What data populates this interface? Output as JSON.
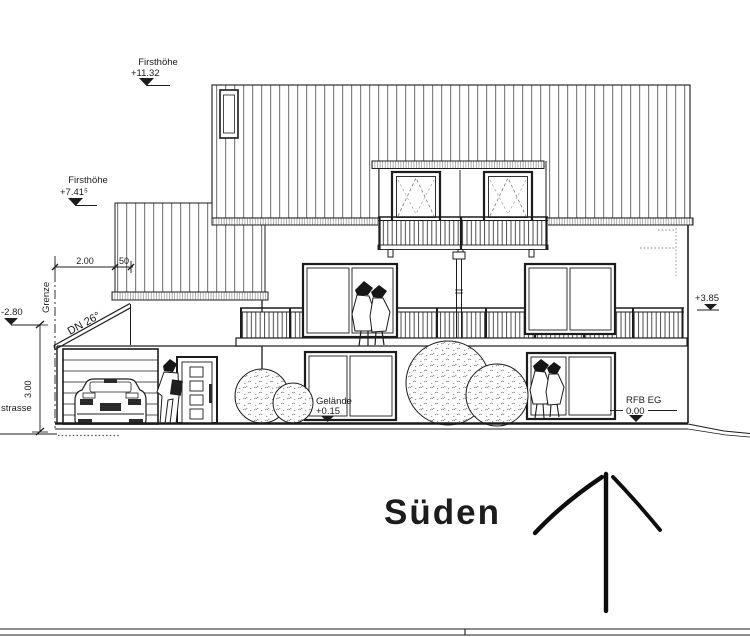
{
  "sheet": {
    "title": "Süden"
  },
  "levels": {
    "ridge_main": {
      "label": "Firsthöhe",
      "value": "+11.32"
    },
    "ridge_garage": {
      "label": "Firsthöhe",
      "value": "+7.41⁵"
    },
    "street_level": {
      "value": "-2.80"
    },
    "street_name": {
      "value": "strasse"
    },
    "terrain": {
      "label": "Gelände",
      "value": "+0.15"
    },
    "floor": {
      "label": "RFB EG",
      "value": "0.00"
    },
    "balcony": {
      "value": "+3.85"
    }
  },
  "dimensions": {
    "boundary_offset": "2.00",
    "eaves_overhang": "50",
    "garage_height": "3.00"
  },
  "labels": {
    "boundary": "Grenze",
    "roof_pitch": "DN 26°"
  },
  "colors": {
    "line": "#1c1c1c",
    "hatch": "#5a5a5a",
    "hidden": "#8a8a8a"
  }
}
